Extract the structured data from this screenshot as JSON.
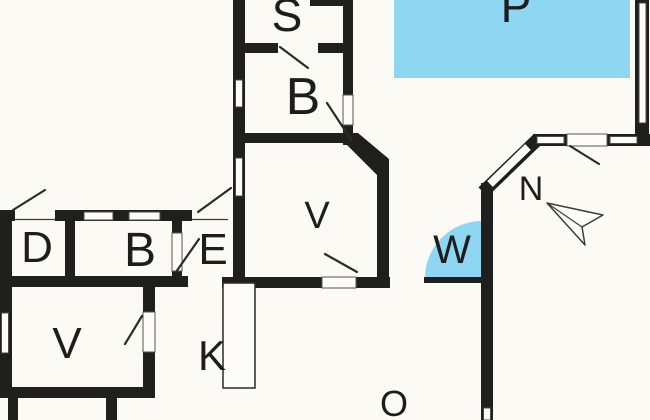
{
  "title": "House floor plan",
  "colors": {
    "background": "#fbfaf5",
    "walls": "#1f1f1d",
    "water": "#8ed6f2",
    "outline": "#3c3c3a"
  },
  "rooms": {
    "s": {
      "label": "S"
    },
    "b_top": {
      "label": "B"
    },
    "p_pool": {
      "label": "P"
    },
    "v_main": {
      "label": "V"
    },
    "n_compass": {
      "label": "N"
    },
    "w_whirlpool": {
      "label": "W"
    },
    "d": {
      "label": "D"
    },
    "b_left": {
      "label": "B"
    },
    "e": {
      "label": "E"
    },
    "v_lower": {
      "label": "V"
    },
    "k": {
      "label": "K"
    },
    "o_outdoor": {
      "label": "O"
    }
  }
}
